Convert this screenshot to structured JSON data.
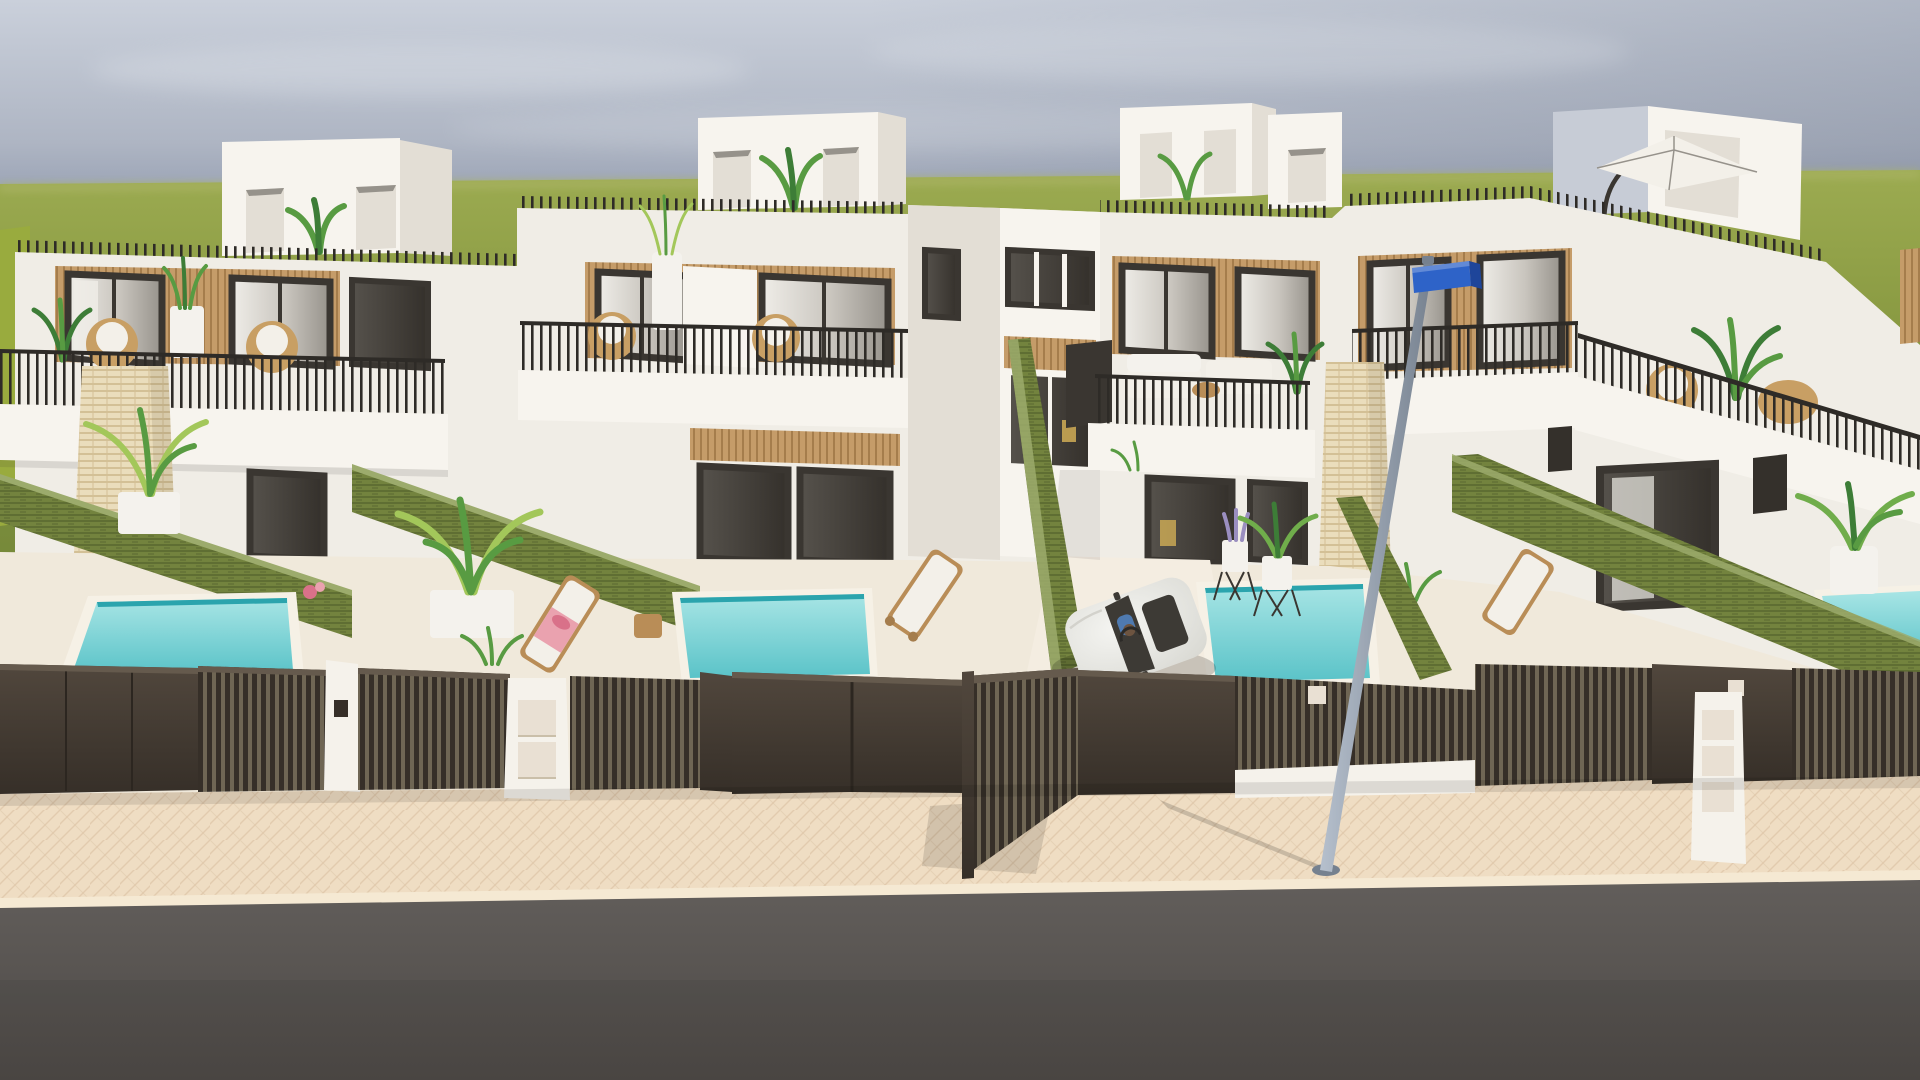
{
  "meta": {
    "type": "architectural-3d-render",
    "subject": "Row of modern two-storey white townhouses with private plunge pools, rooftop terraces, dark slatted street gates, white car exiting a driveway, street lamp with blue street-name sign, beige sidewalk and asphalt road",
    "visible_text": ""
  },
  "palette": {
    "sky_top": "#cad0db",
    "sky_mid": "#aeb5c3",
    "sky_horizon": "#8c96ab",
    "cloud": "#e2e6ec",
    "grass_light": "#9cab51",
    "grass": "#879840",
    "grass_dark": "#76893a",
    "left_wall_green": "#99ab3e",
    "horizon_haze": "#aab465",
    "white_lit": "#f7f4ee",
    "white": "#f0ede6",
    "white_shade": "#e3ded5",
    "white_dark": "#d0cac1",
    "shade_face": "#c7ccd6",
    "wood": "#c59c69",
    "wood_line": "#a57d4c",
    "frame": "#3a3631",
    "glass_a": "#efede8",
    "glass_b": "#c9c5be",
    "glass_c": "#96928b",
    "glass_dark_a": "#56524c",
    "glass_dark_b": "#34302b",
    "curtain": "#eeece6",
    "accent_chair": "#d9b457",
    "railing": "#2e2b27",
    "hedge": "#73833e",
    "hedge_line": "#5f6e33",
    "hedge_top": "#9cab6c",
    "travertine": "#eaddbc",
    "travertine_line": "#d3c096",
    "pool_a": "#a8e5e5",
    "pool_b": "#5ac3c8",
    "pool_line": "#2ba4ad",
    "coping": "#f6f1e6",
    "terrace": "#f0e9db",
    "driveway": "#f4ede1",
    "fence_a": "#51473d",
    "fence_b": "#362f28",
    "fence_gap": "#6f6654",
    "fence_cap": "#655a4d",
    "pillar_white": "#f5f2eb",
    "drawer": "#e9e0d3",
    "drawer_line": "#cabfa9",
    "sidewalk": "#efddc3",
    "pave_line": "#ddc4a5",
    "curb": "#f5e9d3",
    "road": "#625e5b",
    "road_dark": "#4e4a47",
    "pole_a": "#b6c0cd",
    "pole_b": "#76818f",
    "sign_blue": "#2e63c8",
    "sign_side": "#1e459a",
    "car_white": "#f5f5f2",
    "car_shade": "#dadad4",
    "car_glass": "#3d3a35",
    "driver_blue": "#4f7ab0",
    "plant_bright": "#a3c75a",
    "plant": "#70ad4b",
    "plant_mid": "#589b42",
    "plant_dark": "#3d7d37",
    "plant_deep": "#2e6530",
    "lavender": "#9a8ec0",
    "rattan": "#c89f64",
    "cushion": "#f3f0e9",
    "pink": "#eaa2af",
    "pink_deep": "#d97189",
    "pot_white": "#f4f2ed",
    "table_wood": "#b98d57"
  },
  "scene": {
    "sky": "overcast blue-grey gradient, darker toward horizon",
    "field": "flat olive-green grass field at horizon",
    "houses": [
      {
        "label": "townhouse-1",
        "features": [
          "rooftop stair box with two doors and plant",
          "wood-clad upper window recess",
          "balcony with thin black railing and rattan chairs",
          "travertine stone pillar",
          "garden with hedge wall and plunge pool"
        ]
      },
      {
        "label": "townhouse-2",
        "features": [
          "rooftop stair box with plant",
          "wood-clad recess with two glass sliders",
          "balcony planters",
          "ground-floor glass sliders",
          "palm in white planter",
          "lounger with pink towel",
          "plunge pool"
        ]
      },
      {
        "label": "townhouse-3",
        "features": [
          "rooftop stair box",
          "white corner sofa on balcony",
          "privacy screen",
          "driveway with open gate",
          "plunge pool with wire plant stands"
        ]
      },
      {
        "label": "townhouse-4",
        "features": [
          "rooftop terrace with white cantilever parasol",
          "wrap-around balcony",
          "travertine pillar",
          "long hedge wall",
          "corner plunge pool",
          "white potted palm"
        ]
      }
    ],
    "street": {
      "fence": "dark brown aluminium gates, mix of solid and vertical-slat panels with white piers, letterbox pillars and keypads",
      "sidewalk": "beige herringbone paving",
      "road": "dark grey asphalt",
      "lamp": {
        "type": "street light pole, leaning",
        "sign": "blue street-name plate at top"
      }
    },
    "car": {
      "color": "white",
      "state": "exiting central driveway through open slatted gate",
      "occupant": "driver visible through windshield"
    },
    "pools": 4,
    "loungers": 3
  }
}
